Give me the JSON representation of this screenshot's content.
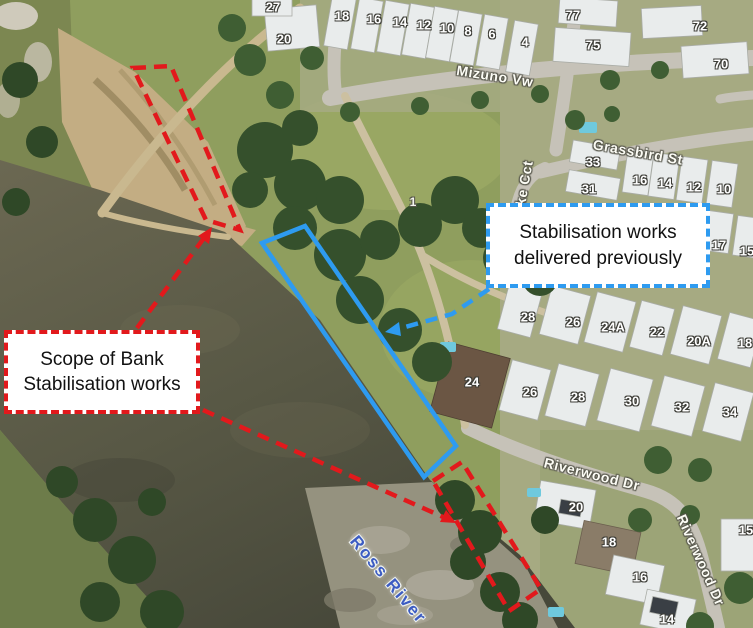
{
  "figure": {
    "description_label": "Aerial map of Ross River bank stabilisation works"
  },
  "callouts": {
    "red": {
      "lines": [
        "Scope of Bank",
        "Stabilisation works"
      ],
      "border_color": "#e2191c"
    },
    "blue": {
      "lines": [
        "Stabilisation works",
        "delivered previously"
      ],
      "border_color": "#2e9bf0"
    }
  },
  "annotation_colors": {
    "scope_red": "#e2191c",
    "previous_blue": "#2e9bf0"
  },
  "map_labels": {
    "street_labels": [
      {
        "t": "Mizuno Vw",
        "x": 495,
        "y": 76,
        "r": 9
      },
      {
        "t": "Grassbird St",
        "x": 638,
        "y": 152,
        "r": 10
      },
      {
        "t": "ke Cct",
        "x": 524,
        "y": 183,
        "r": -80
      },
      {
        "t": "Riverwood Dr",
        "x": 592,
        "y": 474,
        "r": 14
      },
      {
        "t": "Riverwood Dr",
        "x": 701,
        "y": 560,
        "r": 66
      }
    ],
    "river_label": {
      "t": "Ross River",
      "x": 388,
      "y": 580,
      "r": 50
    },
    "parcel_label": {
      "t": "1",
      "x": 413,
      "y": 202,
      "r": 0
    },
    "house_numbers": [
      {
        "t": "27",
        "x": 273,
        "y": 7
      },
      {
        "t": "20",
        "x": 284,
        "y": 39
      },
      {
        "t": "18",
        "x": 342,
        "y": 16
      },
      {
        "t": "16",
        "x": 374,
        "y": 19
      },
      {
        "t": "14",
        "x": 400,
        "y": 22
      },
      {
        "t": "12",
        "x": 424,
        "y": 25
      },
      {
        "t": "10",
        "x": 447,
        "y": 28
      },
      {
        "t": "8",
        "x": 468,
        "y": 31
      },
      {
        "t": "6",
        "x": 492,
        "y": 34
      },
      {
        "t": "4",
        "x": 525,
        "y": 42
      },
      {
        "t": "77",
        "x": 573,
        "y": 15
      },
      {
        "t": "75",
        "x": 593,
        "y": 45
      },
      {
        "t": "72",
        "x": 700,
        "y": 26
      },
      {
        "t": "70",
        "x": 721,
        "y": 64
      },
      {
        "t": "33",
        "x": 593,
        "y": 162
      },
      {
        "t": "31",
        "x": 589,
        "y": 189
      },
      {
        "t": "16",
        "x": 640,
        "y": 180
      },
      {
        "t": "14",
        "x": 665,
        "y": 183
      },
      {
        "t": "12",
        "x": 694,
        "y": 187
      },
      {
        "t": "10",
        "x": 724,
        "y": 189
      },
      {
        "t": "17",
        "x": 719,
        "y": 245
      },
      {
        "t": "15",
        "x": 747,
        "y": 251
      },
      {
        "t": "28",
        "x": 528,
        "y": 317
      },
      {
        "t": "26",
        "x": 573,
        "y": 322
      },
      {
        "t": "24A",
        "x": 613,
        "y": 327
      },
      {
        "t": "22",
        "x": 657,
        "y": 332
      },
      {
        "t": "20A",
        "x": 699,
        "y": 341
      },
      {
        "t": "18",
        "x": 745,
        "y": 343
      },
      {
        "t": "24",
        "x": 472,
        "y": 382
      },
      {
        "t": "26",
        "x": 530,
        "y": 392
      },
      {
        "t": "28",
        "x": 578,
        "y": 397
      },
      {
        "t": "30",
        "x": 632,
        "y": 401
      },
      {
        "t": "32",
        "x": 682,
        "y": 407
      },
      {
        "t": "34",
        "x": 730,
        "y": 412
      },
      {
        "t": "20",
        "x": 576,
        "y": 507
      },
      {
        "t": "15",
        "x": 746,
        "y": 530
      },
      {
        "t": "18",
        "x": 609,
        "y": 542
      },
      {
        "t": "16",
        "x": 640,
        "y": 577
      },
      {
        "t": "14",
        "x": 667,
        "y": 619
      }
    ]
  }
}
